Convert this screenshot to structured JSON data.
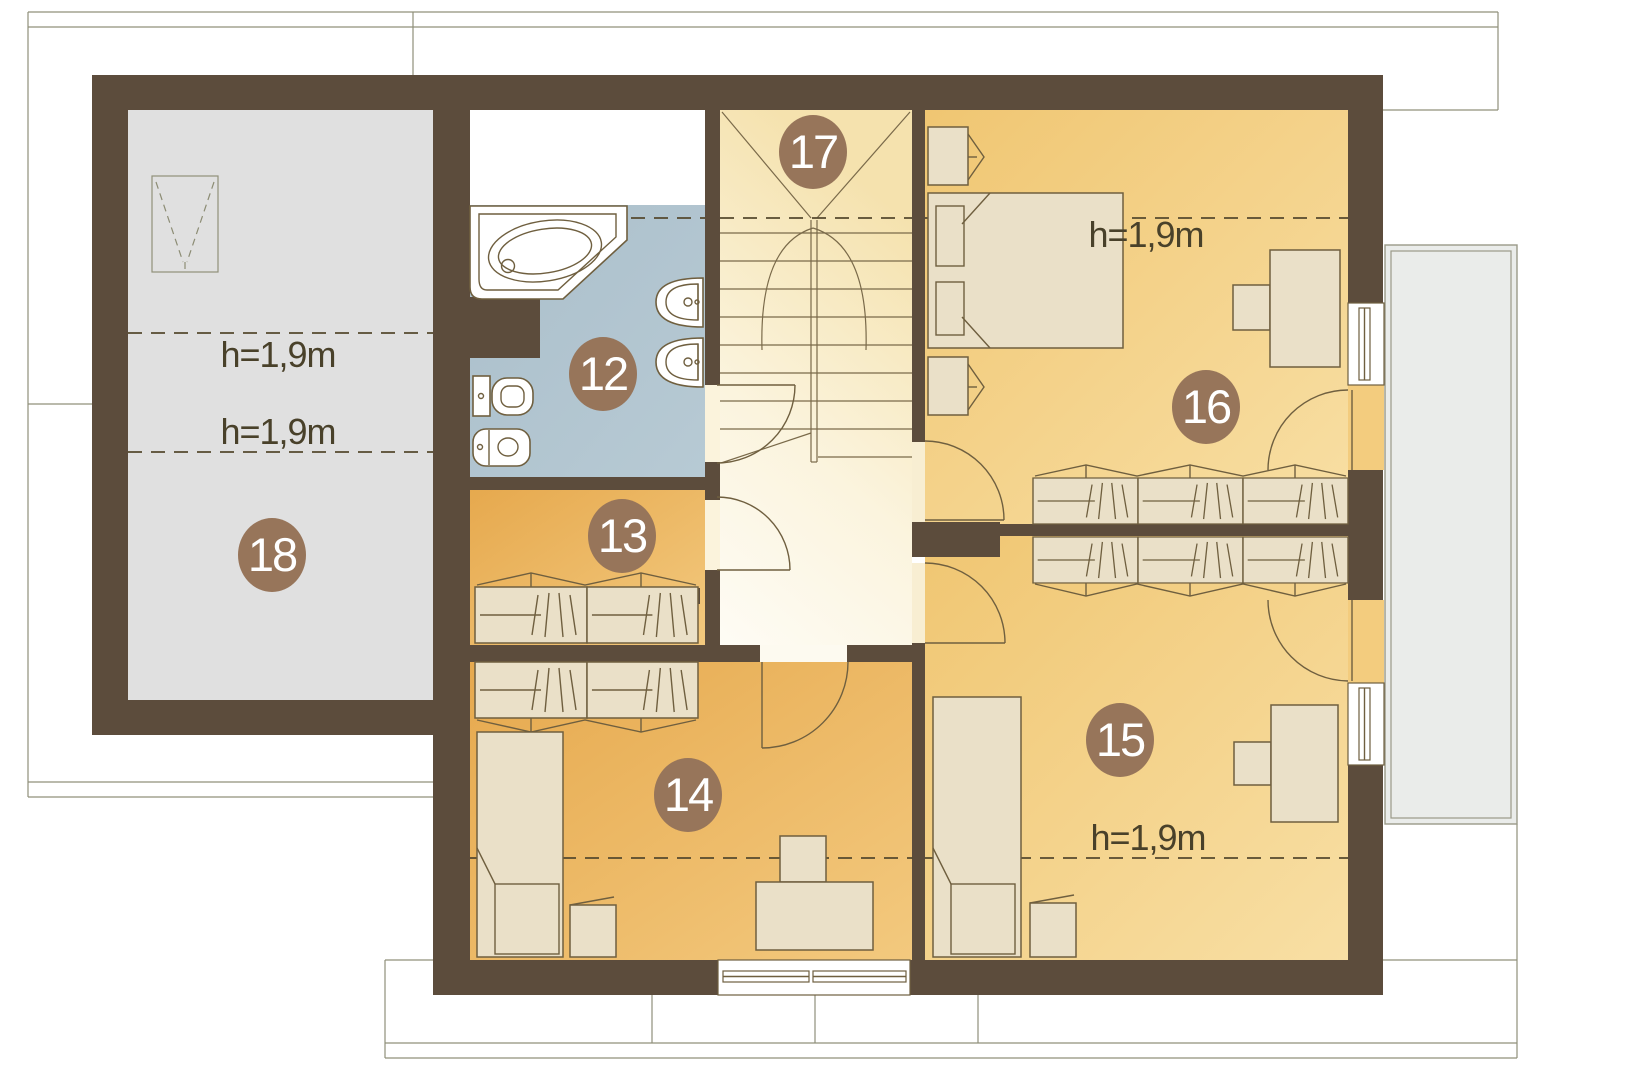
{
  "plan": {
    "type": "architectural floor plan - attic storey",
    "rooms": {
      "room12": {
        "number": "12",
        "kind": "bathroom"
      },
      "room13": {
        "number": "13",
        "kind": "wardrobe"
      },
      "room14": {
        "number": "14",
        "kind": "bedroom"
      },
      "room15": {
        "number": "15",
        "kind": "bedroom"
      },
      "room16": {
        "number": "16",
        "kind": "bedroom"
      },
      "room17": {
        "number": "17",
        "kind": "staircase"
      },
      "room18": {
        "number": "18",
        "kind": "attic-storage"
      }
    },
    "height_annotations": {
      "attic_upper": "h=1,9m",
      "attic_lower": "h=1,9m",
      "bedroom16": "h=1,9m",
      "bedroom15": "h=1,9m"
    },
    "colors": {
      "wall": "#5C4C3C",
      "room_orange": "#E8AC50",
      "room_orange_light": "#F3C97E",
      "room_yellow": "#F1C876",
      "room_yellow_light": "#F8DFA4",
      "bathroom_blue": "#B0C4D0",
      "attic_gray": "#E0E0E0",
      "hall_cream": "#F5E3B2",
      "balcony_gray": "#EAECEA",
      "badge_brown": "#97755A",
      "annotation_text": "#49412A"
    }
  }
}
